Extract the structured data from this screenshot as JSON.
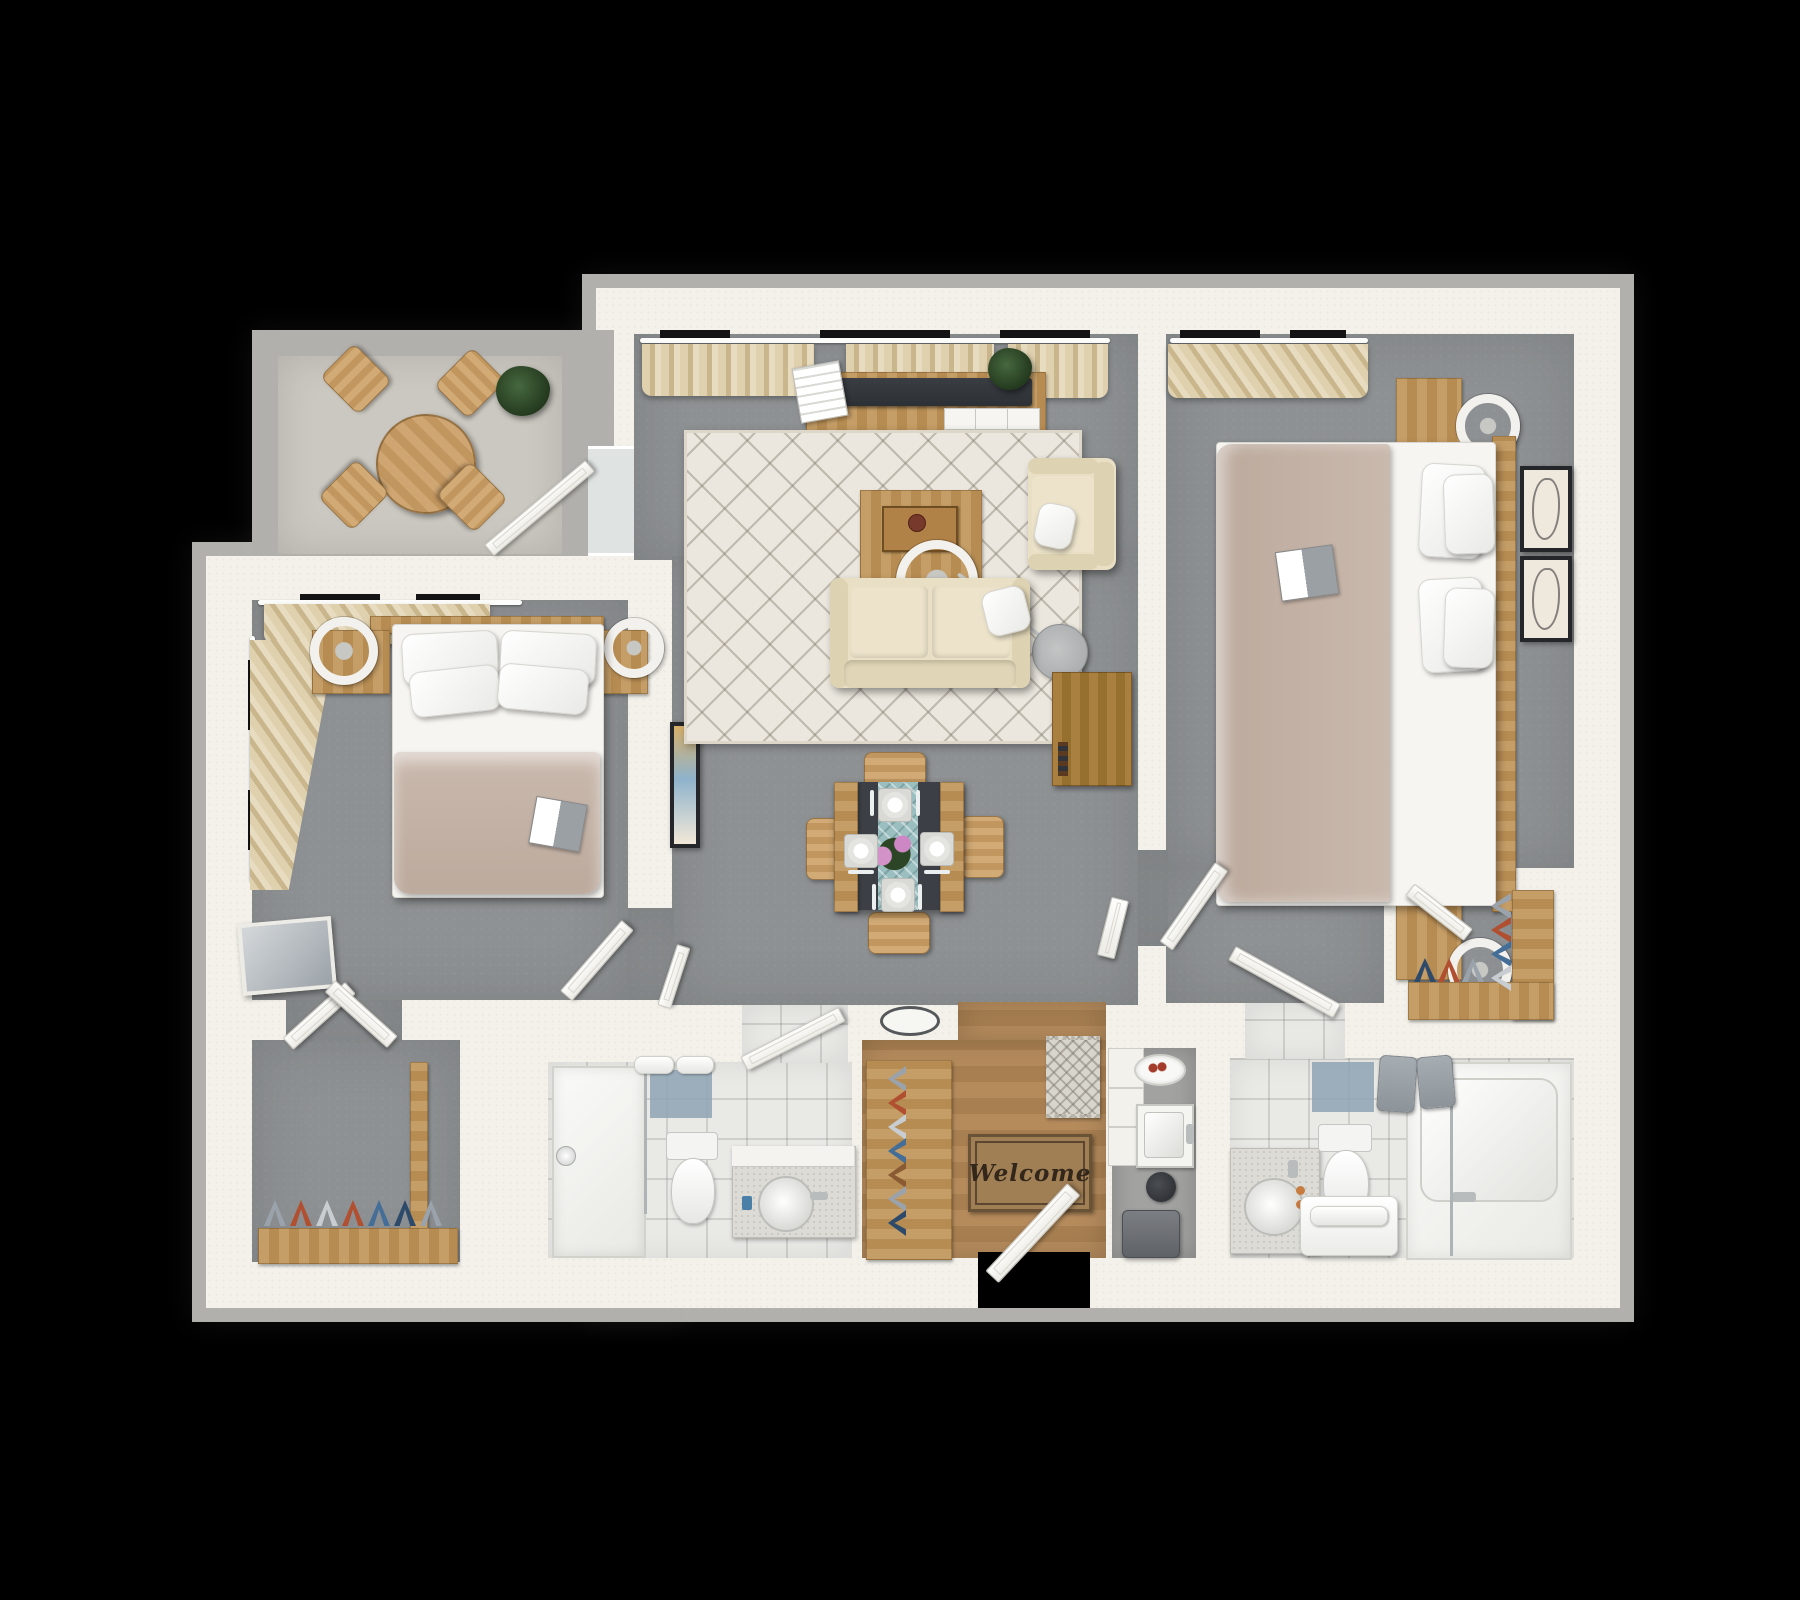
{
  "scene": {
    "type": "3d-rendered-floor-plan",
    "view": "top-down",
    "layout": "2-bedroom 2-bath apartment with balcony",
    "background": "#000000"
  },
  "welcome_mat": {
    "text": "Welcome"
  },
  "palette": {
    "bg": "#000000",
    "wallgray": "#b2b0ad",
    "wall": "#f3f1ea",
    "carpet": "#8e9193",
    "balconyfloor": "#cbc8c1",
    "woodfloor": "#b58b5c",
    "woodfloor2": "#a87f51",
    "tile": "#e9e9e6",
    "tileblue": "#8ea3b4",
    "curtain": "#dfd0ae",
    "curtain2": "#c9b68d",
    "wood": "#c59d66",
    "wood2": "#b68c52",
    "wooddark": "#a9803f",
    "wooddark2": "#96702f",
    "sofa": "#e8dfc4",
    "rug": "#ebe7de",
    "duvet": "#c9b8ac",
    "sheet": "#f6f5f1",
    "tv": "#2d3136",
    "tabledark": "#3c4046",
    "runner": "#9bbec0",
    "towelgray": "#9aa1a6",
    "matbrown": "#a07f55",
    "mattext": "#33261a",
    "frame": "#24262a",
    "shoered": "#b05030",
    "shoeblue": "#446e97",
    "shoegray": "#9aa3ab",
    "shoenavy": "#2e4a6b",
    "shoetan": "#8a5a33",
    "shoelight": "#c8cdd2"
  },
  "rooms": {
    "balcony": [
      "round-bistro-table",
      "bistro-chair x4",
      "potted-plant",
      "sliding-glass-door"
    ],
    "living_room": [
      "window-curtains",
      "tv-console",
      "flat-tv",
      "magazines",
      "console-plant",
      "area-rug",
      "coffee-table",
      "serving-tray",
      "arc-floor-lamp",
      "loveseat-sofa",
      "throw-pillow",
      "armchair",
      "bookshelf-cart",
      "dining-table",
      "dining-chair x4",
      "place-setting x4",
      "table-runner",
      "flower-centerpiece",
      "wall-art"
    ],
    "bedroom_1": [
      "window-curtains x2",
      "headboard",
      "double-bed",
      "pillow x4",
      "book",
      "nightstand x2",
      "ring-lamp x2",
      "leaning-mirror",
      "closet-double-door",
      "entry-door"
    ],
    "walk_in_closet": [
      "shoe-rack",
      "shoes x7"
    ],
    "bathroom_1": [
      "walk-in-shower",
      "glass-screen",
      "shower-head",
      "accent-tiles",
      "rolled-towels x2",
      "toilet",
      "vanity",
      "round-sink",
      "faucet"
    ],
    "hallway": [
      "floor-vent",
      "bathroom-door",
      "linen-door"
    ],
    "entry": [
      "wood-floor",
      "welcome-mat",
      "runner-rug",
      "front-door",
      "shoe-rack",
      "shoes x7"
    ],
    "utility_nook": [
      "shelf-unit",
      "utility-sink",
      "berry-bowl",
      "hair-dryer",
      "waste-bin"
    ],
    "bedroom_2": [
      "window-curtains",
      "double-bed",
      "pillow x4",
      "book",
      "headboard",
      "nightstand x2",
      "ring-lamp x2",
      "framed-art x2",
      "room-door",
      "ensuite-door",
      "closet-door"
    ],
    "closet_2": [
      "l-shoe-rack",
      "shoes x10"
    ],
    "bathroom_2": [
      "vanity",
      "round-sink",
      "toothbrush-cups",
      "toilet",
      "towel-bench",
      "bathtub",
      "glass-screen",
      "hanging-towels x2",
      "accent-tiles"
    ]
  }
}
